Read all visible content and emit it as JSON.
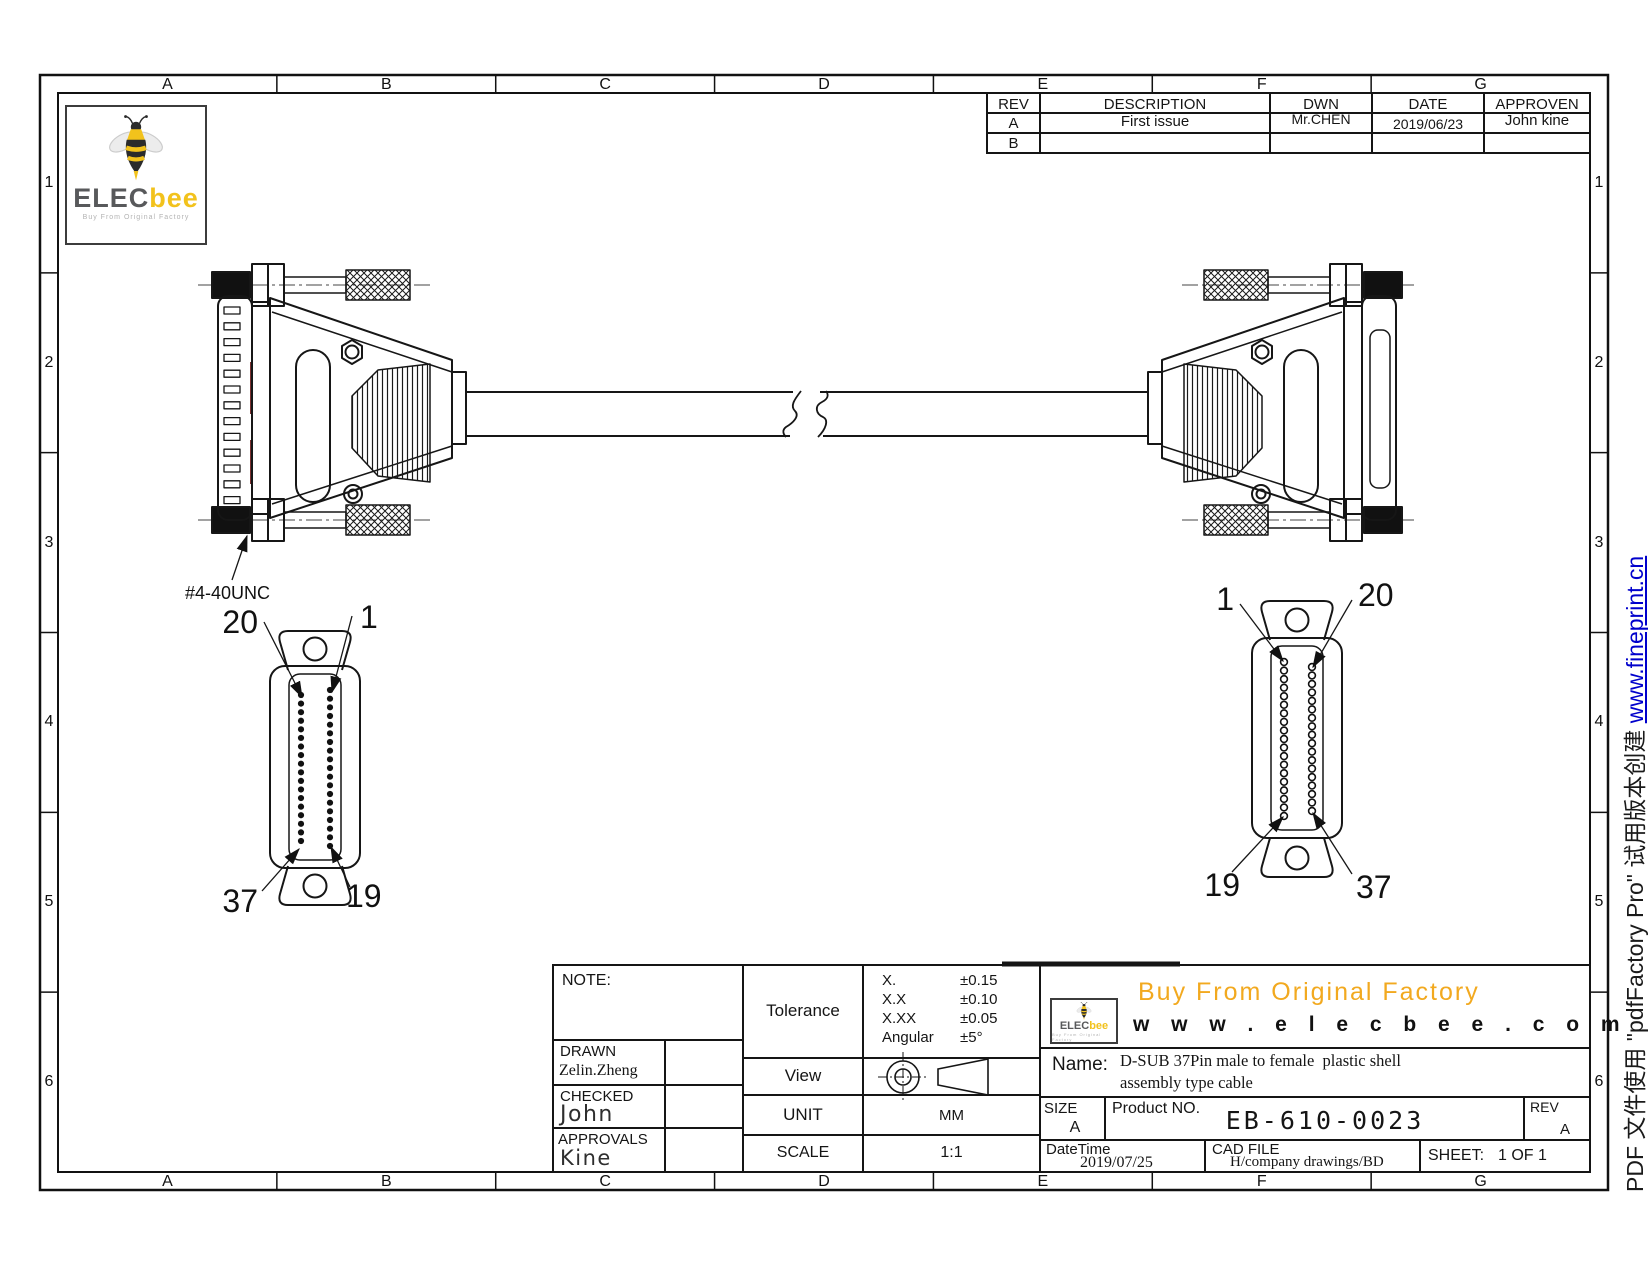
{
  "page": {
    "zone_letters": [
      "A",
      "B",
      "C",
      "D",
      "E",
      "F",
      "G"
    ],
    "zone_numbers": [
      "1",
      "2",
      "3",
      "4",
      "5",
      "6"
    ]
  },
  "logo": {
    "brand_elec": "ELEC",
    "brand_bee": "bee",
    "tagline": "Buy From Original Factory"
  },
  "revision_table": {
    "headers": [
      "REV",
      "DESCRIPTION",
      "DWN",
      "DATE",
      "APPROVEN"
    ],
    "rows": [
      {
        "rev": "A",
        "description": "First issue",
        "dwn": "Mr.CHEN",
        "date": "2019/06/23",
        "approven": "John kine"
      },
      {
        "rev": "B",
        "description": "",
        "dwn": "",
        "date": "",
        "approven": ""
      }
    ]
  },
  "drawing": {
    "thread_label": "#4-40UNC",
    "left_face": {
      "top_left": "20",
      "top_right": "1",
      "bottom_left": "37",
      "bottom_right": "19",
      "left_pins": 18,
      "right_pins": 19
    },
    "right_face": {
      "top_left": "1",
      "top_right": "20",
      "bottom_left": "19",
      "bottom_right": "37",
      "left_pins": 19,
      "right_pins": 18
    }
  },
  "title_block": {
    "note_label": "NOTE:",
    "drawn_label": "DRAWN",
    "drawn_name": "Zelin.Zheng",
    "checked_label": "CHECKED",
    "checked_name": "John",
    "approvals_label": "APPROVALS",
    "approvals_name": "Kine",
    "tolerance_label": "Tolerance",
    "tolerance_rows": [
      [
        "X.",
        "±0.15"
      ],
      [
        "X.X",
        "±0.10"
      ],
      [
        "X.XX",
        "±0.05"
      ],
      [
        "Angular",
        "±5°"
      ]
    ],
    "view_label": "View",
    "unit_label": "UNIT",
    "unit_value": "MM",
    "scale_label": "SCALE",
    "scale_value": "1:1",
    "banner_title": "Buy From Original Factory",
    "banner_url": "w w w . e l e c b e e . c o m",
    "name_label": "Name:",
    "name_line1": "D-SUB 37Pin male to female  plastic shell",
    "name_line2": "assembly type cable",
    "size_label": "SIZE",
    "size_value": "A",
    "product_label": "Product NO.",
    "product_value": "EB-610-0023",
    "rev_label": "REV",
    "rev_value": "A",
    "datetime_label": "DateTime",
    "datetime_value": "2019/07/25",
    "cadfile_label": "CAD FILE",
    "cadfile_value": "H/company drawings/BD",
    "sheet_label": "SHEET:",
    "sheet_value": "1 OF 1"
  },
  "watermark": {
    "prefix": "PDF 文件使用 \"pdfFactory Pro\" 试用版本创建 ",
    "link": "www.fineprint.cn"
  }
}
